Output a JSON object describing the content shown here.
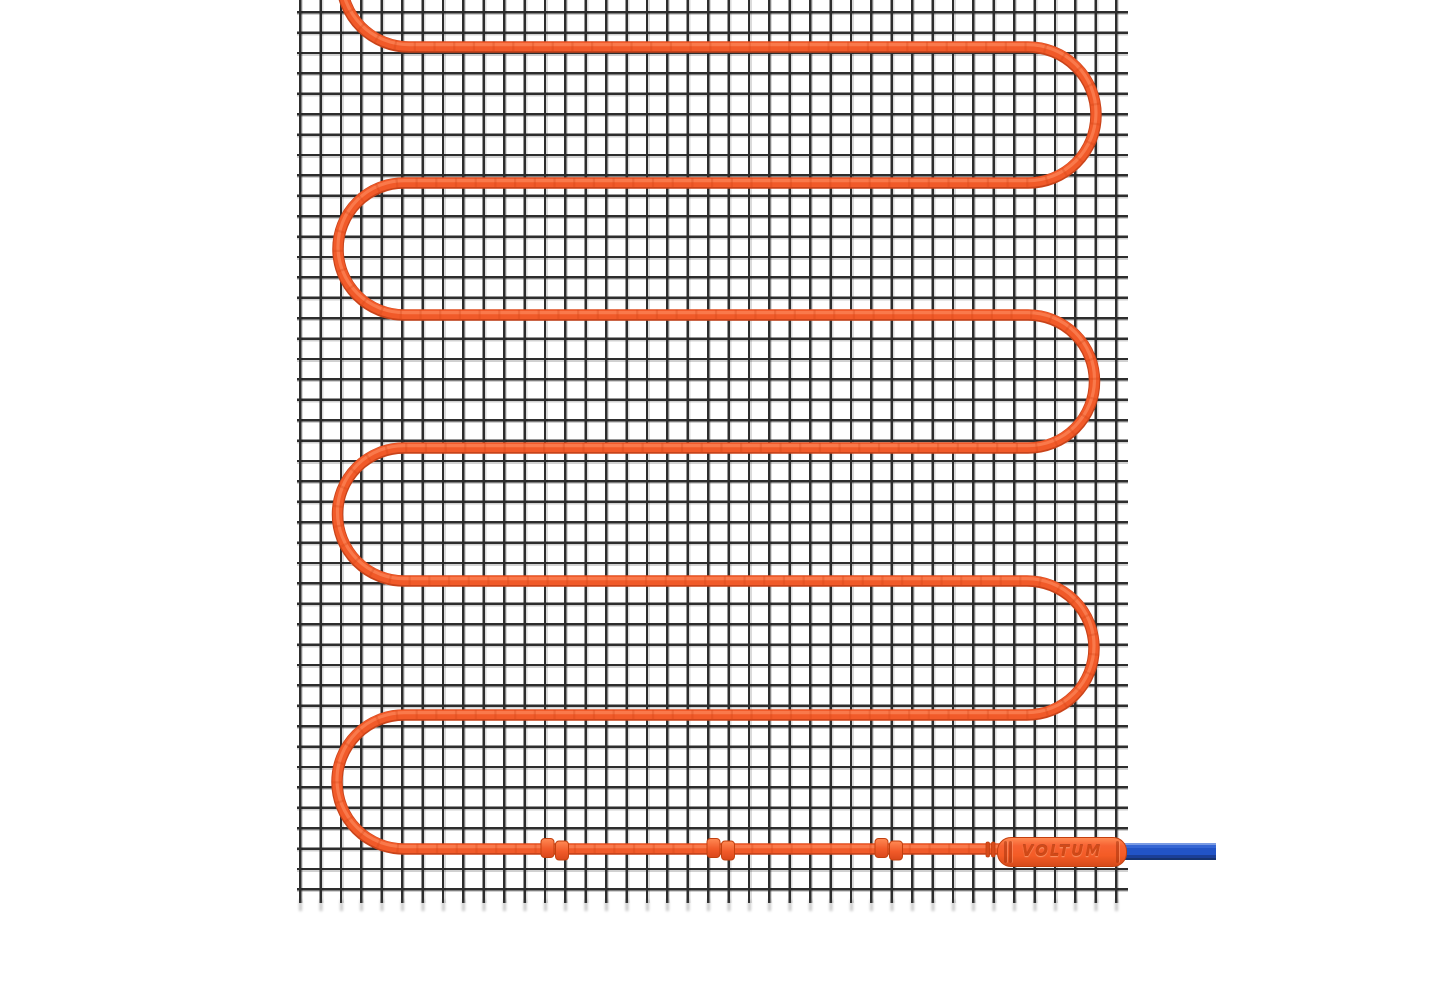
{
  "scene": {
    "type": "product-render",
    "subject": "electric-underfloor-heating-mat",
    "connector": {
      "brand_label": "VOLTUM"
    },
    "counts": {
      "horizontal_cable_runs": 7,
      "cable_clips": 3
    },
    "colors": {
      "background": "#ffffff",
      "mesh_line": "#2d2d2d",
      "cable_main": "#f15a29",
      "cable_shadow": "#c8431a",
      "cable_highlight": "#ff9468",
      "cable_texture": "#cf4517",
      "connector_body": "#f45c26",
      "connector_body_light": "#ff8a52",
      "connector_body_dark": "#d64a1a",
      "connector_outline": "#c2400f",
      "connector_text": "#c94513",
      "cold_lead_blue": "#2254c6",
      "cold_lead_blue_light": "#7a9be4",
      "cold_lead_blue_dark": "#16336f"
    }
  }
}
